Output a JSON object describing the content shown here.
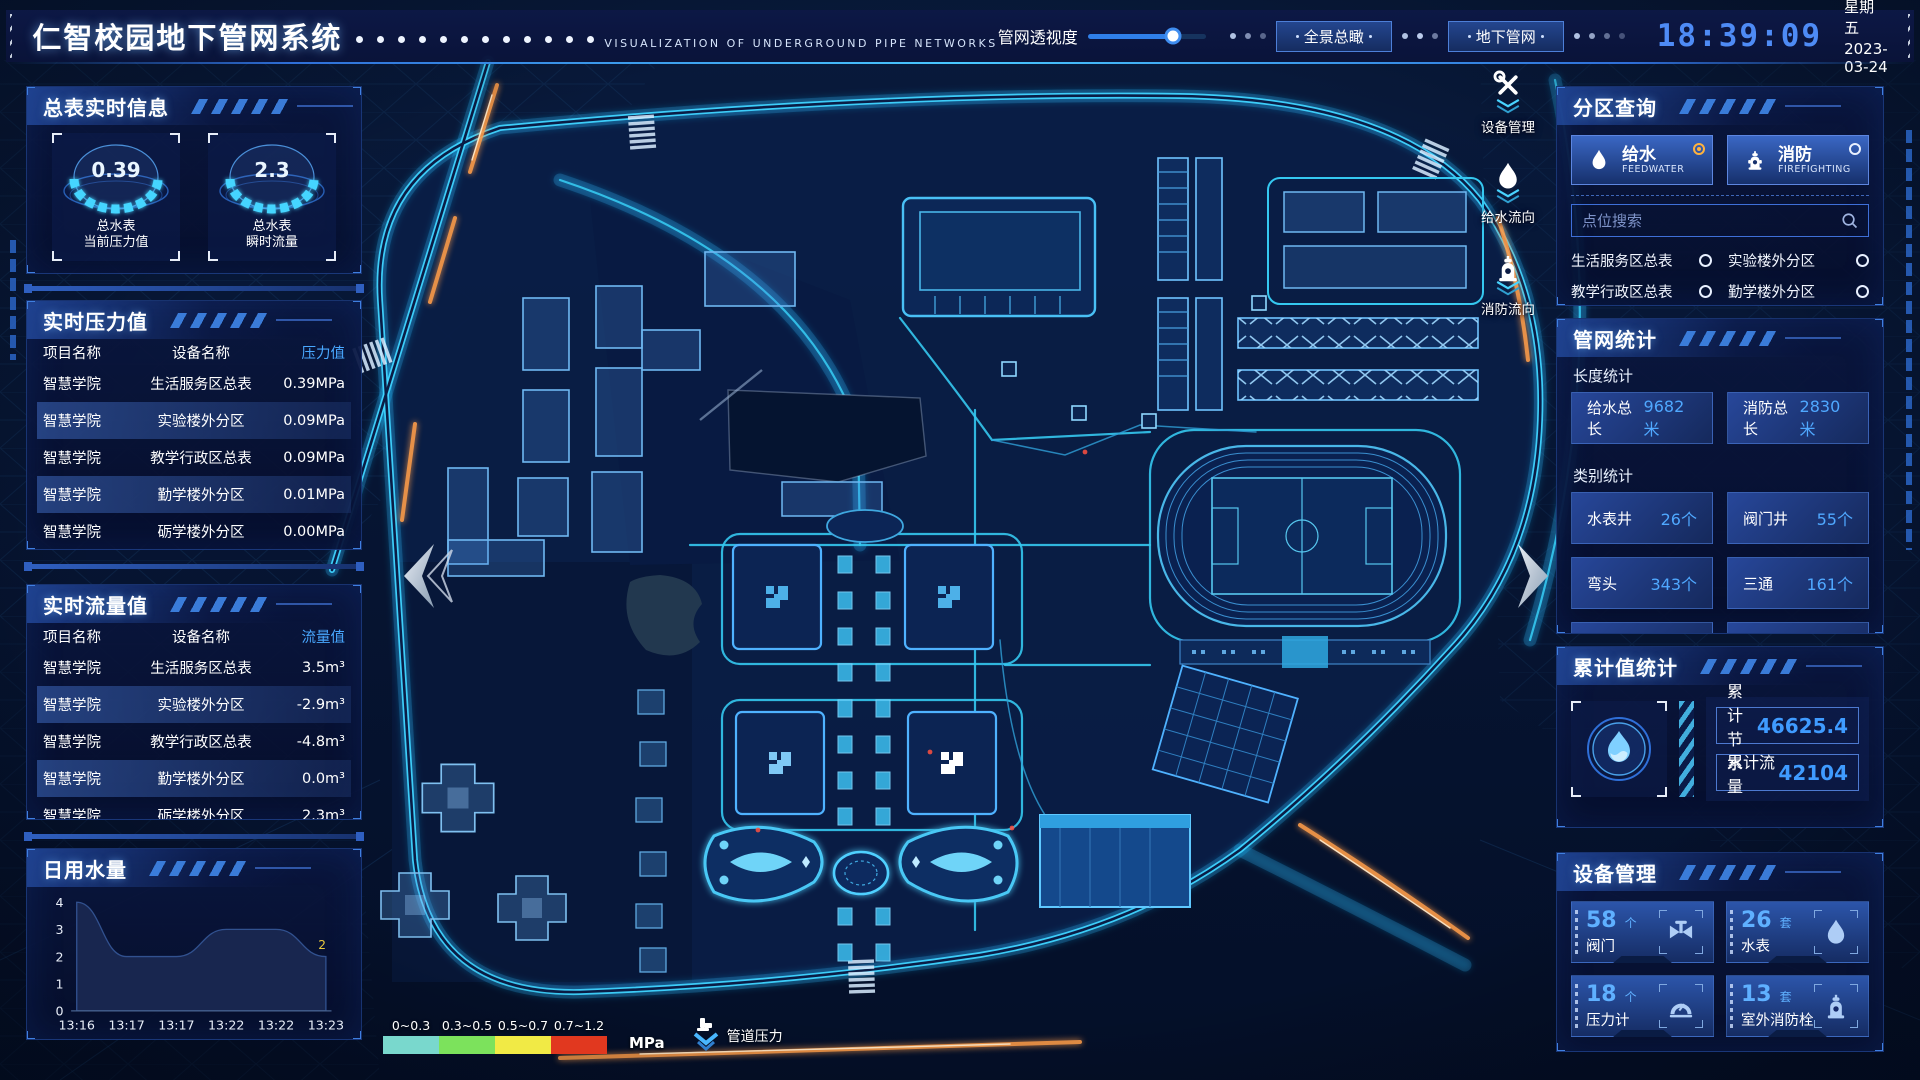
{
  "header": {
    "title": "仁智校园地下管网系统",
    "subtitle": "VISUALIZATION OF UNDERGROUND PIPE NETWORKS",
    "slider_label": "管网透视度",
    "btn_overview": "全景总瞰",
    "btn_underground": "地下管网",
    "time": "18:39:09",
    "weekday": "星期五",
    "date": "2023-03-24"
  },
  "meter_info": {
    "title": "总表实时信息",
    "gauges": [
      {
        "value": "0.39",
        "line1": "总水表",
        "line2": "当前压力值"
      },
      {
        "value": "2.3",
        "line1": "总水表",
        "line2": "瞬时流量"
      }
    ]
  },
  "pressure": {
    "title": "实时压力值",
    "h1": "项目名称",
    "h2": "设备名称",
    "h3": "压力值",
    "rows": [
      {
        "p": "智慧学院",
        "d": "生活服务区总表",
        "v": "0.39MPa"
      },
      {
        "p": "智慧学院",
        "d": "实验楼外分区",
        "v": "0.09MPa"
      },
      {
        "p": "智慧学院",
        "d": "教学行政区总表",
        "v": "0.09MPa"
      },
      {
        "p": "智慧学院",
        "d": "勤学楼外分区",
        "v": "0.01MPa"
      },
      {
        "p": "智慧学院",
        "d": "砺学楼外分区",
        "v": "0.00MPa"
      }
    ]
  },
  "flow": {
    "title": "实时流量值",
    "h1": "项目名称",
    "h2": "设备名称",
    "h3": "流量值",
    "rows": [
      {
        "p": "智慧学院",
        "d": "生活服务区总表",
        "v": "3.5m³"
      },
      {
        "p": "智慧学院",
        "d": "实验楼外分区",
        "v": "-2.9m³"
      },
      {
        "p": "智慧学院",
        "d": "教学行政区总表",
        "v": "-4.8m³"
      },
      {
        "p": "智慧学院",
        "d": "勤学楼外分区",
        "v": "0.0m³"
      },
      {
        "p": "智慧学院",
        "d": "砺学楼外分区",
        "v": "2.3m³"
      }
    ]
  },
  "daily": {
    "title": "日用水量"
  },
  "chart_data": {
    "type": "area",
    "title": "日用水量",
    "x": [
      "13:16",
      "13:17",
      "13:17",
      "13:22",
      "13:22",
      "13:23"
    ],
    "values": [
      4,
      2,
      2,
      3,
      3,
      2
    ],
    "yticks": [
      "4",
      "3",
      "2",
      "1",
      "0"
    ],
    "ylim": [
      0,
      4
    ],
    "grid": false,
    "legend_position": "none",
    "end_label": "2",
    "end_label_color": "#e9c93e",
    "fill_color": "#18264f"
  },
  "zone": {
    "title": "分区查询",
    "tab1": {
      "label": "给水",
      "sub": "FEEDWATER",
      "selected": true
    },
    "tab2": {
      "label": "消防",
      "sub": "FIREFIGHTING",
      "selected": false
    },
    "search_placeholder": "点位搜索",
    "points": [
      "生活服务区总表",
      "实验楼外分区",
      "教学行政区总表",
      "勤学楼外分区",
      "砺学楼外分区",
      "宿舍区泵房"
    ]
  },
  "pipe_stats": {
    "title": "管网统计",
    "len_title": "长度统计",
    "len": [
      {
        "label": "给水总长",
        "value": "9682米"
      },
      {
        "label": "消防总长",
        "value": "2830米"
      }
    ],
    "cat_title": "类别统计",
    "cat": [
      {
        "label": "水表井",
        "value": "26个"
      },
      {
        "label": "阀门井",
        "value": "55个"
      },
      {
        "label": "弯头",
        "value": "343个"
      },
      {
        "label": "三通",
        "value": "161个"
      }
    ]
  },
  "cumulative": {
    "title": "累计值统计",
    "icon": "waterdrop-icon",
    "rows": [
      {
        "label": "累计节水",
        "value": "46625.4"
      },
      {
        "label": "累计流量",
        "value": "42104"
      }
    ]
  },
  "devices": {
    "title": "设备管理",
    "items": [
      {
        "count": "58",
        "unit": "个",
        "label": "阀门",
        "icon": "valve-icon"
      },
      {
        "count": "26",
        "unit": "套",
        "label": "水表",
        "icon": "water-meter-icon"
      },
      {
        "count": "18",
        "unit": "个",
        "label": "压力计",
        "icon": "pressure-gauge-icon"
      },
      {
        "count": "13",
        "unit": "套",
        "label": "室外消防栓",
        "icon": "hydrant-icon"
      }
    ]
  },
  "map_tools": [
    {
      "label": "设备管理",
      "icon": "wrench-icon"
    },
    {
      "label": "给水流向",
      "icon": "waterdrop-icon"
    },
    {
      "label": "消防流向",
      "icon": "hydrant-icon"
    }
  ],
  "legend": {
    "ranges": [
      {
        "label": "0~0.3",
        "color": "#79d8cd"
      },
      {
        "label": "0.3~0.5",
        "color": "#7ce25c"
      },
      {
        "label": "0.5~0.7",
        "color": "#f1ea45"
      },
      {
        "label": "0.7~1.2",
        "color": "#e1381f"
      }
    ],
    "unit": "MPa",
    "label": "管道压力"
  },
  "colors": {
    "accent": "#35c8ff",
    "time": "#4e8bf5",
    "value_blue": "#4fa8ff",
    "selected_radio": "#ffb23e",
    "road_orange": "#ff9d4a"
  }
}
